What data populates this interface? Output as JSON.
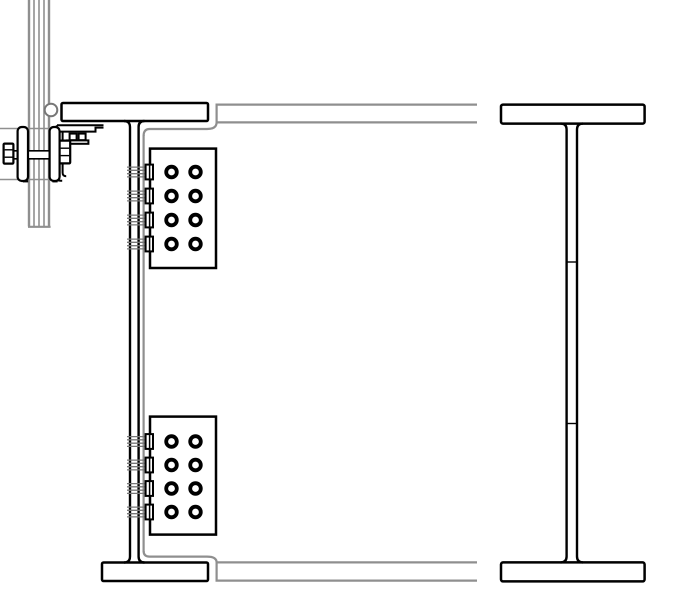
{
  "canvas": {
    "w": 700,
    "h": 595,
    "bg": "#ffffff"
  },
  "palette": {
    "ink": "#000000",
    "hidden": "#8f8f8f",
    "soft": "#777777",
    "paper": "#ffffff"
  },
  "layers": [
    {
      "name": "hanger-rod-bundle",
      "shapes": [
        {
          "t": "line",
          "x1": 29,
          "y1": 0,
          "x2": 29,
          "y2": 226.5,
          "w": 2.4,
          "c": "hidden",
          "name": "rod-line-outer"
        },
        {
          "t": "line",
          "x1": 34,
          "y1": 0,
          "x2": 34,
          "y2": 226.5,
          "w": 1.6,
          "c": "hidden",
          "name": "rod-line"
        },
        {
          "t": "line",
          "x1": 39,
          "y1": 0,
          "x2": 39,
          "y2": 226.5,
          "w": 1.6,
          "c": "hidden",
          "name": "rod-line"
        },
        {
          "t": "line",
          "x1": 44,
          "y1": 0,
          "x2": 44,
          "y2": 226.5,
          "w": 1.6,
          "c": "hidden",
          "name": "rod-line"
        },
        {
          "t": "line",
          "x1": 49,
          "y1": 0,
          "x2": 49,
          "y2": 226.5,
          "w": 2.4,
          "c": "hidden",
          "name": "rod-line-outer"
        },
        {
          "t": "line",
          "x1": 28,
          "y1": 226.8,
          "x2": 50.6,
          "y2": 226.8,
          "w": 2.2,
          "c": "hidden",
          "name": "rod-end-cap"
        }
      ]
    },
    {
      "name": "clamp-cross-bars",
      "shapes": [
        {
          "t": "line",
          "x1": 0,
          "y1": 128.5,
          "x2": 60,
          "y2": 128.5,
          "w": 1.6,
          "c": "hidden",
          "name": "cross-bar-line"
        },
        {
          "t": "line",
          "x1": 0,
          "y1": 179.5,
          "x2": 60,
          "y2": 179.5,
          "w": 1.6,
          "c": "hidden",
          "name": "cross-bar-line"
        }
      ]
    },
    {
      "name": "clamp-bolt-shank",
      "shapes": [
        {
          "t": "rect",
          "x": 13,
          "y": 150.8,
          "w": 47,
          "h": 8,
          "sw": 0,
          "f": "paper",
          "name": "shank-mask"
        },
        {
          "t": "line",
          "x1": 13,
          "y1": 150.8,
          "x2": 60,
          "y2": 150.8,
          "w": 1.7,
          "c": "ink",
          "name": "shank-line"
        },
        {
          "t": "line",
          "x1": 13,
          "y1": 158.8,
          "x2": 60,
          "y2": 158.8,
          "w": 1.7,
          "c": "ink",
          "name": "shank-line"
        }
      ]
    },
    {
      "name": "pin-circle",
      "shapes": [
        {
          "t": "circle",
          "cx": 51,
          "cy": 110,
          "r": 6.3,
          "sw": 2,
          "c": "soft",
          "f": "paper",
          "name": "pin-circle"
        }
      ]
    },
    {
      "name": "hidden-girder",
      "shapes": [
        {
          "t": "path",
          "d": "M 477,104.6 L 216.6,104.6 L 216.6,122.4 L 477,122.4",
          "sw": 2.2,
          "c": "hidden",
          "name": "girder-top-flange"
        },
        {
          "t": "path",
          "d": "M 143.6,136 Q 143.6,129 149.6,129 L 207,129 Q 216.6,129 216.6,122.4",
          "sw": 2.2,
          "c": "hidden",
          "name": "girder-top-cope"
        },
        {
          "t": "path",
          "d": "M 143.6,135 L 143.6,552",
          "sw": 2.2,
          "c": "hidden",
          "name": "girder-web-edge"
        },
        {
          "t": "path",
          "d": "M 143.6,551 Q 143.6,556.6 149.6,556.6 L 207,556.6 Q 216.6,556.6 216.6,562.4",
          "sw": 2.2,
          "c": "hidden",
          "name": "girder-bottom-cope"
        },
        {
          "t": "path",
          "d": "M 477,562.4 L 216.6,562.4 L 216.6,580.6 L 477,580.6",
          "sw": 2.2,
          "c": "hidden",
          "name": "girder-bottom-flange"
        }
      ]
    },
    {
      "name": "left-beam",
      "shapes": [
        {
          "t": "rect",
          "x": 61.5,
          "y": 103,
          "w": 146.5,
          "h": 18,
          "sw": 2.5,
          "c": "ink",
          "f": "paper",
          "rx": 1.5,
          "name": "left-beam-top-flange"
        },
        {
          "t": "rect",
          "x": 102,
          "y": 562.5,
          "w": 106,
          "h": 18.5,
          "sw": 2.5,
          "c": "ink",
          "f": "paper",
          "rx": 1.5,
          "name": "left-beam-bottom-flange"
        },
        {
          "t": "path",
          "d": "M 124,121 Q 130,121 130,127 L 130,556.5 Q 130,562.5 124,562.5",
          "sw": 2.4,
          "c": "ink",
          "name": "left-beam-web-near-line"
        },
        {
          "t": "path",
          "d": "M 144.5,121 Q 138.6,121 138.6,127 L 138.6,556.5 Q 138.6,562.5 144.5,562.5",
          "sw": 2.4,
          "c": "ink",
          "name": "left-beam-web-far-line"
        }
      ]
    },
    {
      "name": "seat-bracket",
      "shapes": [
        {
          "t": "path",
          "d": "M 57,125.2 L 103.5,125.2",
          "sw": 2,
          "c": "ink",
          "name": "seat-top-line"
        },
        {
          "t": "path",
          "d": "M 56.8,131.6 L 95.5,131.6 L 95.5,127.6 L 103.5,127.6",
          "sw": 2,
          "c": "ink",
          "name": "seat-step-line"
        },
        {
          "t": "path",
          "d": "M 56.8,125.2 L 56.8,177.2 Q 56.8,180.8 60.6,180.8 L 62.2,180.8",
          "sw": 2,
          "c": "ink",
          "name": "seat-leg-outer"
        },
        {
          "t": "path",
          "d": "M 62.6,131.6 L 62.6,172.6 Q 62.6,176.2 66.2,176.2",
          "sw": 2,
          "c": "ink",
          "name": "seat-leg-inner"
        },
        {
          "t": "rect",
          "x": 69.6,
          "y": 133.6,
          "w": 7,
          "h": 6.6,
          "sw": 2,
          "c": "ink",
          "f": "paper",
          "name": "seat-bolt-head"
        },
        {
          "t": "rect",
          "x": 78.6,
          "y": 133.6,
          "w": 7,
          "h": 6.6,
          "sw": 2,
          "c": "ink",
          "f": "paper",
          "name": "seat-bolt-head"
        },
        {
          "t": "rect",
          "x": 67,
          "y": 140.4,
          "w": 21.4,
          "h": 3.4,
          "sw": 2,
          "c": "ink",
          "f": "paper",
          "name": "seat-bolt-base"
        }
      ]
    },
    {
      "name": "clamp-hardware",
      "shapes": [
        {
          "t": "rect",
          "x": 17.6,
          "y": 127,
          "w": 10.4,
          "h": 54,
          "rx": 4.2,
          "sw": 2.2,
          "c": "ink",
          "f": "paper",
          "name": "clamp-washer-left"
        },
        {
          "t": "rect",
          "x": 49.6,
          "y": 127,
          "w": 10,
          "h": 54,
          "rx": 4.2,
          "sw": 2.2,
          "c": "ink",
          "f": "paper",
          "name": "clamp-washer-right"
        },
        {
          "t": "rect",
          "x": 3.6,
          "y": 143.6,
          "w": 9.8,
          "h": 20,
          "rx": 1,
          "sw": 2.2,
          "c": "ink",
          "f": "paper",
          "name": "clamp-bolt-head"
        },
        {
          "t": "line",
          "x1": 4.6,
          "y1": 149.8,
          "x2": 12.6,
          "y2": 149.8,
          "w": 1.4,
          "c": "ink",
          "name": "head-facet-line"
        },
        {
          "t": "line",
          "x1": 4.6,
          "y1": 157.2,
          "x2": 12.6,
          "y2": 157.2,
          "w": 1.4,
          "c": "ink",
          "name": "head-facet-line"
        },
        {
          "t": "rect",
          "x": 59.6,
          "y": 140.6,
          "w": 10.6,
          "h": 22.8,
          "rx": 1,
          "sw": 2.2,
          "c": "ink",
          "f": "paper",
          "name": "clamp-nut"
        },
        {
          "t": "line",
          "x1": 60.6,
          "y1": 148.2,
          "x2": 69.2,
          "y2": 148.2,
          "w": 1.4,
          "c": "ink",
          "name": "nut-facet-line"
        },
        {
          "t": "line",
          "x1": 60.6,
          "y1": 155.6,
          "x2": 69.2,
          "y2": 155.6,
          "w": 1.4,
          "c": "ink",
          "name": "nut-facet-line"
        },
        {
          "t": "line",
          "x1": 23,
          "y1": 181.3,
          "x2": 28.2,
          "y2": 181.3,
          "w": 2.2,
          "c": "ink",
          "name": "washer-foot-tick"
        },
        {
          "t": "line",
          "x1": 52.4,
          "y1": 181.3,
          "x2": 57.6,
          "y2": 181.3,
          "w": 2.2,
          "c": "ink",
          "name": "washer-foot-tick"
        }
      ]
    },
    {
      "name": "right-beam",
      "shapes": [
        {
          "t": "rect",
          "x": 501,
          "y": 104.6,
          "w": 143.6,
          "h": 19,
          "sw": 2.5,
          "c": "ink",
          "f": "paper",
          "rx": 2,
          "name": "right-beam-top-flange"
        },
        {
          "t": "rect",
          "x": 501,
          "y": 562.4,
          "w": 143.6,
          "h": 19,
          "sw": 2.5,
          "c": "ink",
          "f": "paper",
          "rx": 2,
          "name": "right-beam-bottom-flange"
        },
        {
          "t": "path",
          "d": "M 560.6,123.6 Q 566.6,123.6 566.6,129.6 L 566.6,556.4 Q 566.6,562.4 560.6,562.4",
          "sw": 2.4,
          "c": "ink",
          "name": "right-beam-web-near-line"
        },
        {
          "t": "path",
          "d": "M 583,123.6 Q 577,123.6 577,129.6 L 577,556.4 Q 577,562.4 583,562.4",
          "sw": 2.4,
          "c": "ink",
          "name": "right-beam-web-far-line"
        },
        {
          "t": "line",
          "x1": 566.6,
          "y1": 262,
          "x2": 577,
          "y2": 262,
          "w": 1.4,
          "c": "ink",
          "name": "web-splice-tick"
        },
        {
          "t": "line",
          "x1": 566.6,
          "y1": 423.5,
          "x2": 577,
          "y2": 423.5,
          "w": 1.4,
          "c": "ink",
          "name": "web-splice-tick"
        }
      ]
    }
  ],
  "bolt_groups": [
    {
      "name": "upper-bolt-group",
      "plate": {
        "x": 150,
        "y": 148.6,
        "w": 66,
        "h": 119.4
      },
      "rows": [
        172,
        196,
        220,
        244
      ],
      "cols": [
        171.5,
        195.5
      ]
    },
    {
      "name": "lower-bolt-group",
      "plate": {
        "x": 150,
        "y": 416.6,
        "w": 66,
        "h": 118
      },
      "rows": [
        441.5,
        465,
        488.5,
        512
      ],
      "cols": [
        171.5,
        195.5
      ]
    }
  ],
  "bolt_style": {
    "outer_r": 7.2,
    "ring_w": 3.8,
    "shank_x1": 127,
    "shank_x2": 146,
    "shank_dy": [
      -4.9,
      -1.7,
      1.7,
      4.9
    ],
    "nut_x": 145.6,
    "nut_w": 7.4,
    "nut_half_h": 7.4,
    "nut_edge_x": 149.6,
    "plate_stroke": 2.5
  }
}
